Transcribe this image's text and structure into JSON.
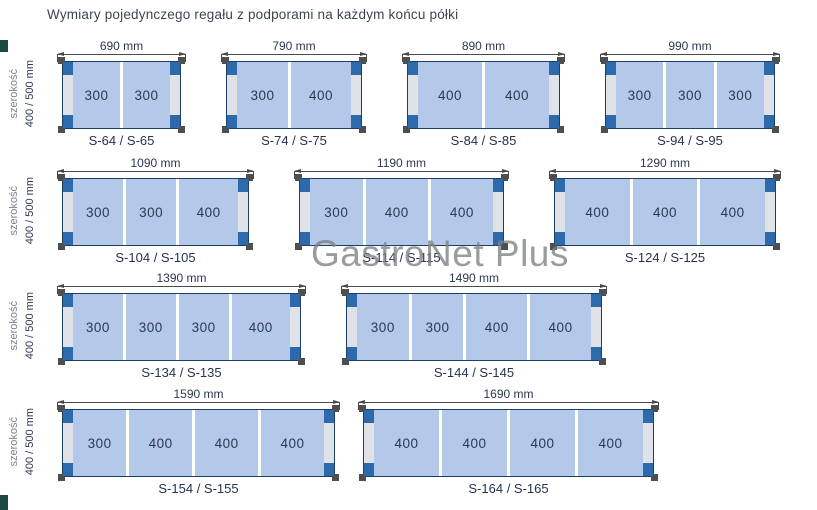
{
  "title": "Wymiary pojedynczego regału z podporami na każdym końcu półki",
  "watermark": "GastroNet Plus",
  "side_label": {
    "axis": "szerokość",
    "value": "400 / 500 mm"
  },
  "colors": {
    "shelf_fill": "#b4c9ea",
    "shelf_border": "#1c3e67",
    "support_cap": "#2d6aab",
    "support_strip": "#dfe2e6",
    "foot": "#4c4e50",
    "dimension": "#4a4a4a",
    "text": "#2c3850",
    "watermark": "#7d8184",
    "accent": "#1a4a42"
  },
  "rows": [
    {
      "diagrams": [
        {
          "length_mm": 690,
          "length_label": "690 mm",
          "segments": [
            300,
            300
          ],
          "model": "S-64 / S-65"
        },
        {
          "length_mm": 790,
          "length_label": "790 mm",
          "segments": [
            300,
            400
          ],
          "model": "S-74 / S-75"
        },
        {
          "length_mm": 890,
          "length_label": "890 mm",
          "segments": [
            400,
            400
          ],
          "model": "S-84 / S-85"
        },
        {
          "length_mm": 990,
          "length_label": "990 mm",
          "segments": [
            300,
            300,
            300
          ],
          "model": "S-94 / S-95"
        }
      ]
    },
    {
      "diagrams": [
        {
          "length_mm": 1090,
          "length_label": "1090 mm",
          "segments": [
            300,
            300,
            400
          ],
          "model": "S-104 / S-105"
        },
        {
          "length_mm": 1190,
          "length_label": "1190 mm",
          "segments": [
            300,
            400,
            400
          ],
          "model": "S-114 / S-115"
        },
        {
          "length_mm": 1290,
          "length_label": "1290 mm",
          "segments": [
            400,
            400,
            400
          ],
          "model": "S-124 / S-125"
        }
      ]
    },
    {
      "diagrams": [
        {
          "length_mm": 1390,
          "length_label": "1390 mm",
          "segments": [
            300,
            300,
            300,
            400
          ],
          "model": "S-134 / S-135"
        },
        {
          "length_mm": 1490,
          "length_label": "1490 mm",
          "segments": [
            300,
            300,
            400,
            400
          ],
          "model": "S-144 / S-145"
        }
      ]
    },
    {
      "diagrams": [
        {
          "length_mm": 1590,
          "length_label": "1590 mm",
          "segments": [
            300,
            400,
            400,
            400
          ],
          "model": "S-154 / S-155"
        },
        {
          "length_mm": 1690,
          "length_label": "1690 mm",
          "segments": [
            400,
            400,
            400,
            400
          ],
          "model": "S-164 / S-165"
        }
      ]
    }
  ]
}
